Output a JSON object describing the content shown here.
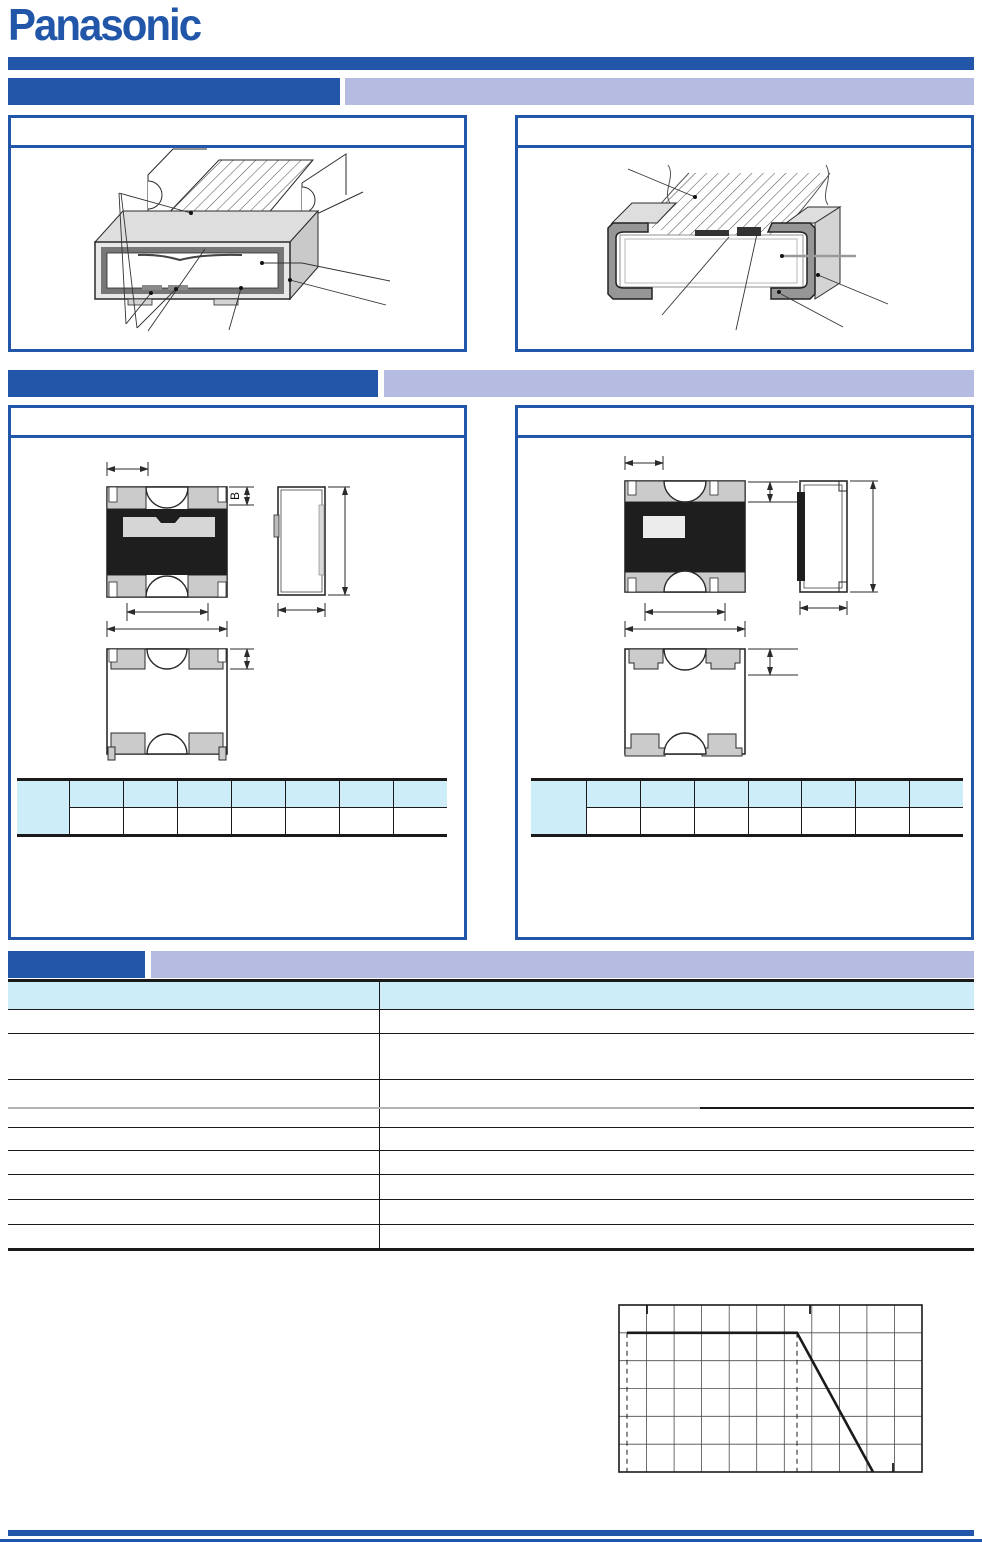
{
  "brand": {
    "logo_text": "Panasonic"
  },
  "colors": {
    "brand_blue": "#2156A8",
    "bar_lavender": "#B5BBE1",
    "table_header_cyan": "#CDEDF8",
    "line_black": "#1a1a1a"
  },
  "section_bars": [
    {
      "label": ""
    },
    {
      "label": ""
    },
    {
      "label": ""
    }
  ],
  "construction": {
    "left_panel": {
      "caption": ""
    },
    "right_panel": {
      "caption": ""
    }
  },
  "dimensions": {
    "left_panel": {
      "caption": "",
      "b_label": "B",
      "table": {
        "corner": "",
        "headers": [
          "",
          "",
          "",
          "",
          "",
          "",
          ""
        ],
        "values": [
          "",
          "",
          "",
          "",
          "",
          "",
          ""
        ]
      }
    },
    "right_panel": {
      "caption": "",
      "table": {
        "corner": "",
        "headers": [
          "",
          "",
          "",
          "",
          "",
          "",
          ""
        ],
        "values": [
          "",
          "",
          "",
          "",
          "",
          "",
          ""
        ]
      }
    }
  },
  "specifications": {
    "header": [
      "",
      ""
    ],
    "rows": [
      [
        "",
        ""
      ],
      [
        "",
        ""
      ],
      [
        "",
        ""
      ],
      [
        "",
        ""
      ],
      [
        "",
        ""
      ],
      [
        "",
        ""
      ],
      [
        "",
        ""
      ],
      [
        "",
        ""
      ],
      [
        "",
        ""
      ]
    ]
  },
  "derating_graph": {
    "type": "line",
    "grid_columns": 11,
    "grid_rows": 6,
    "curve_points_fraction": [
      [
        0.026,
        0.167
      ],
      [
        0.588,
        0.167
      ],
      [
        0.838,
        1.0
      ]
    ],
    "dashed_guides_x_fraction": [
      0.026,
      0.588
    ],
    "legend": ""
  }
}
